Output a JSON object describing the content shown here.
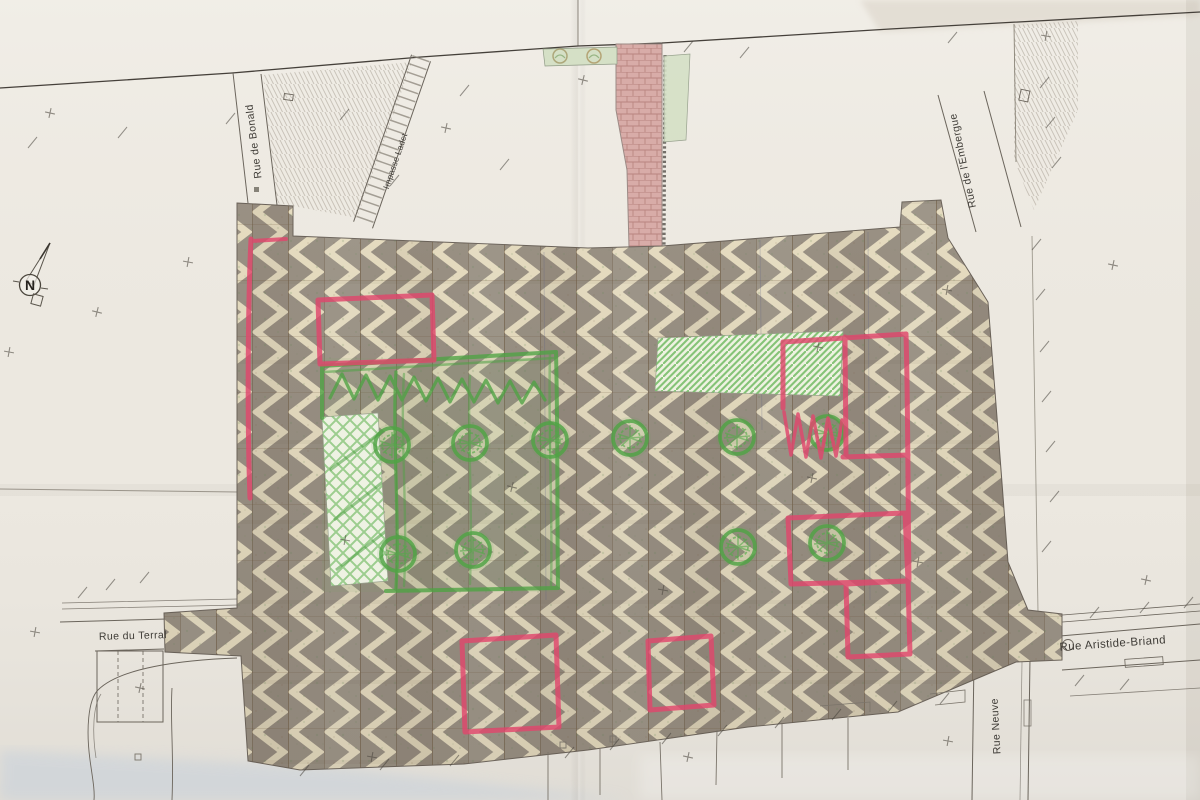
{
  "plan": {
    "streets": {
      "rue_de_bonald": {
        "label": "Rue de Bonald"
      },
      "impasse_ladet": {
        "label": "Impasse Ladet"
      },
      "rue_de_l_embergue": {
        "label": "Rue de l'Embergue"
      },
      "rue_du_terral": {
        "label": "Rue du Terral"
      },
      "rue_aristide_briand": {
        "label": "Rue Aristide-Briand"
      },
      "rue_neuve": {
        "label": "Rue Neuve"
      }
    },
    "north_arrow": {
      "label": "N"
    },
    "surface": {
      "paving_pattern": "chevron",
      "paving_color": "#9a9184",
      "paving_stripe_color": "#e7ddc1"
    },
    "annotations": {
      "red_marker": {
        "color": "#e0476d",
        "shapes": [
          "west edge vertical line",
          "north-west rectangle",
          "north-east L-shaped zone with squiggle",
          "east rectangle",
          "south-east rectangle",
          "south square left",
          "south square right"
        ]
      },
      "green_marker": {
        "color": "#4fa344",
        "tree_count": 10,
        "shapes": [
          "outlined zone with zigzag scribble",
          "cross-hatched strip",
          "diagonal-hatched strip north-east",
          "tree circles in two rows"
        ]
      }
    }
  }
}
